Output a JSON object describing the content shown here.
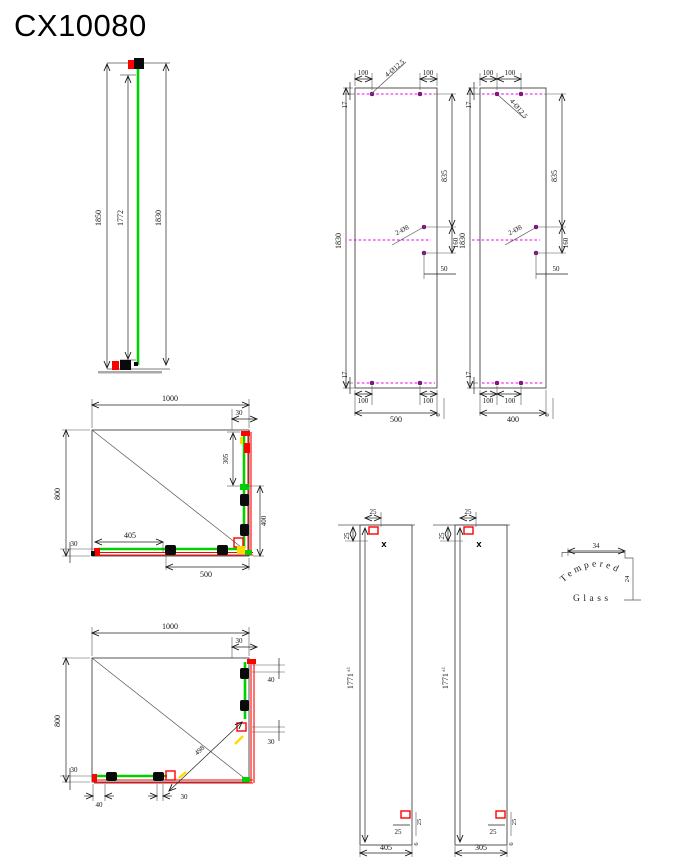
{
  "title": "CX10080",
  "colors": {
    "glass_green": "#00cf00",
    "profile_red": "#ff0000",
    "centerline_magenta": "#ee00ee",
    "accent_yellow": "#ffd900",
    "line": "#333333"
  },
  "side_view": {
    "overall_height": "1850",
    "inner_height": "1772",
    "glass_height": "1830"
  },
  "drill_left": {
    "top_offset_left": "100",
    "top_offset_right": "100",
    "top_hole_note": "4-Ø12.5",
    "top_edge": "17",
    "upper_span": "835",
    "height": "1830",
    "mid_hole_note": "2-Ø8",
    "mid_spacing": "160",
    "mid_edge_offset": "50",
    "bottom_edge": "17",
    "bottom_offset_left": "100",
    "bottom_offset_right": "100",
    "width": "500",
    "thickness": "6"
  },
  "drill_right": {
    "top_offset_left": "100",
    "top_offset_right": "100",
    "top_hole_note": "4-Ø12.5",
    "top_edge": "17",
    "upper_span": "835",
    "height": "1830",
    "mid_hole_note": "2-Ø8",
    "mid_spacing": "160",
    "mid_edge_offset": "50",
    "bottom_edge": "17",
    "bottom_offset_left": "100",
    "bottom_offset_right": "100",
    "width": "400",
    "thickness": "6"
  },
  "plan_top": {
    "width": "1000",
    "corner_offset": "30",
    "upper_right": "305",
    "lower_right": "400",
    "height": "800",
    "left_offset": "30",
    "bar_length": "405",
    "bottom_length": "500"
  },
  "plan_bottom": {
    "width": "1000",
    "corner_offset": "30",
    "right_upper": "40",
    "right_lower": "30",
    "height": "800",
    "left_offset": "30",
    "bottom_a": "40",
    "bottom_b": "30",
    "diagonal": "498"
  },
  "glass_left": {
    "top_offset": "25",
    "side_offset": "25",
    "hole_mark": "X",
    "height": "1771",
    "height_tol": "±1",
    "bottom_offset": "25",
    "edge_offset": "25",
    "width": "405",
    "thickness": "6"
  },
  "glass_right": {
    "top_offset": "25",
    "side_offset": "25",
    "hole_mark": "X",
    "height": "1771",
    "height_tol": "±1",
    "bottom_offset": "25",
    "edge_offset": "25",
    "width": "305",
    "thickness": "6"
  },
  "stamp": {
    "arc_text": "Tempered",
    "base_text": "Glass",
    "dim_top": "34",
    "dim_side": "24"
  }
}
